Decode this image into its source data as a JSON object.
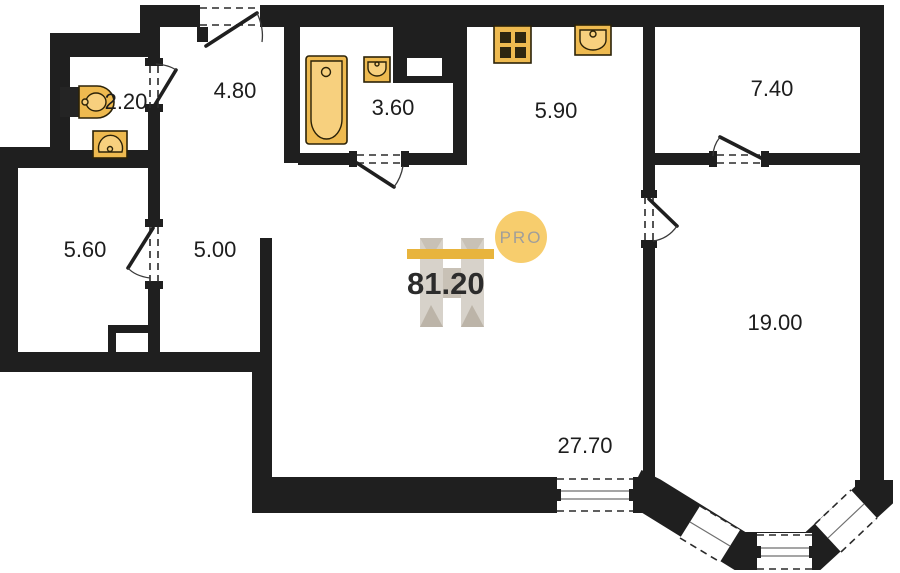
{
  "plan": {
    "title": "apartment-floor-plan",
    "total_area": "81.20",
    "rooms": {
      "wc": "2.20",
      "hallway": "4.80",
      "bathroom": "3.60",
      "kitchen": "5.90",
      "room_small": "7.40",
      "storage": "5.60",
      "corridor": "5.00",
      "bedroom": "19.00",
      "living": "27.70"
    },
    "logo_badge": "PRO",
    "colors": {
      "wall": "#1f1f1f",
      "fixture": "#eeba50",
      "fixture_inner": "#f7d07e",
      "accent_gold": "#e8b43d",
      "badge_bg": "#f7cd6d",
      "badge_text": "#a09e9a",
      "watermark_gray": "#d7d2ca"
    }
  }
}
